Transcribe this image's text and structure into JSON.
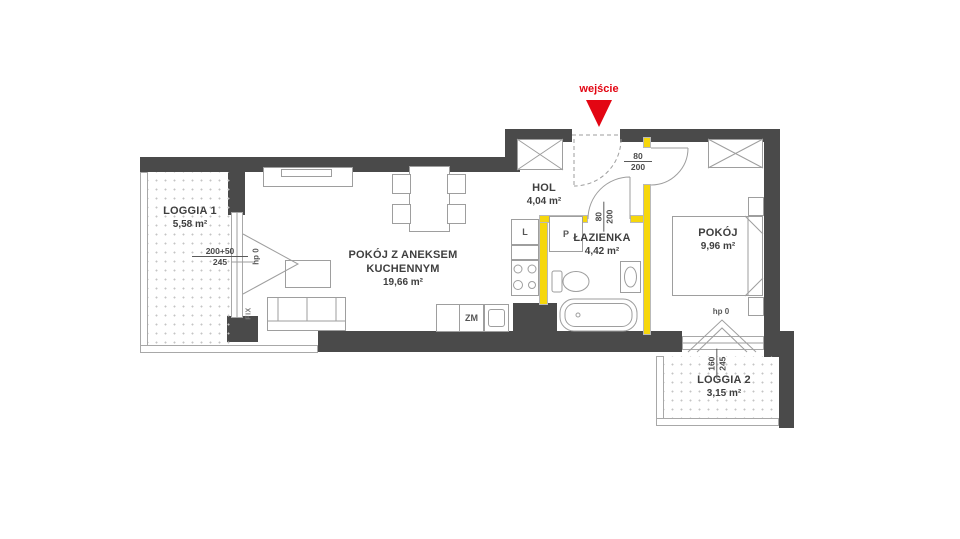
{
  "entrance": {
    "label": "wejście"
  },
  "rooms": {
    "hol": {
      "name": "HOL",
      "area": "4,04 m²"
    },
    "bathroom": {
      "name": "ŁAZIENKA",
      "area": "4,42 m²"
    },
    "bedroom": {
      "name": "POKÓJ",
      "area": "9,96 m²"
    },
    "living": {
      "name": "POKÓJ Z ANEKSEM KUCHENNYM",
      "area": "19,66 m²"
    },
    "loggia1": {
      "name": "LOGGIA 1",
      "area": "5,58 m²"
    },
    "loggia2": {
      "name": "LOGGIA 2",
      "area": "3,15 m²"
    }
  },
  "dimensions": {
    "bedroom_door": {
      "num": "80",
      "den": "200"
    },
    "bathroom_door": {
      "num": "80",
      "den": "200"
    },
    "loggia1_window": {
      "num": "200+50",
      "den": "245"
    },
    "loggia2_window": {
      "num": "160",
      "den": "245"
    },
    "hp_left": "hp 0",
    "hp_right": "hp 0",
    "fix_label": "FIX"
  },
  "appliances": {
    "fridge": "L",
    "washer": "P",
    "dishwasher": "ZM"
  },
  "colors": {
    "wall": "#4a4a4a",
    "partition": "#f6d70c",
    "entrance": "#e30613",
    "line": "#9e9e9e",
    "text": "#3f3f3f"
  }
}
